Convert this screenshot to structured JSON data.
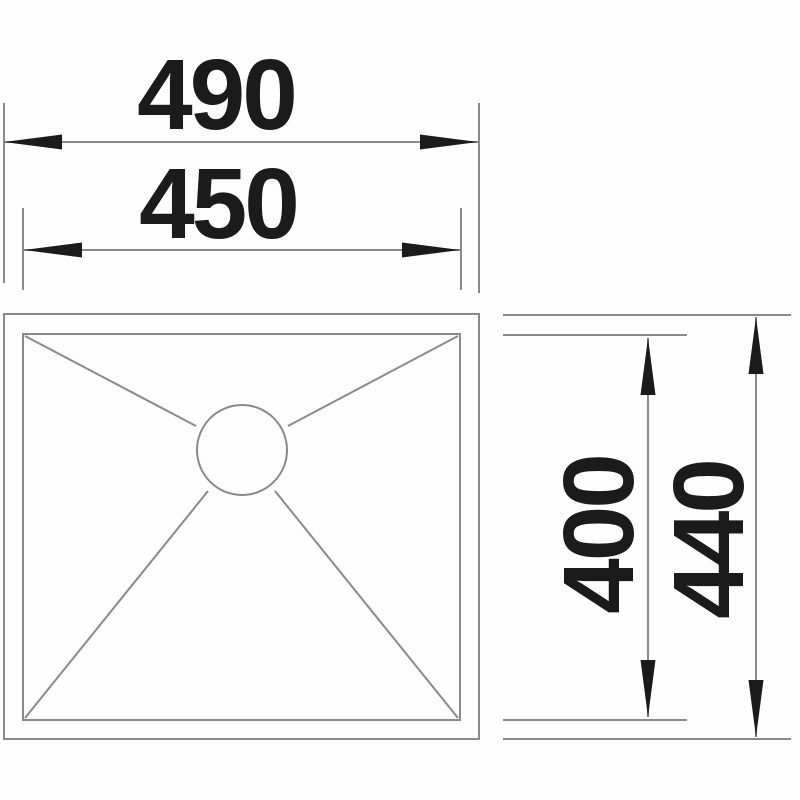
{
  "diagram": {
    "kind": "technical-dimension-drawing",
    "colors": {
      "line": "#8a8a8a",
      "ink": "#1b1b1b",
      "background": "#fdfdfd"
    },
    "dimensions": {
      "outer_width": {
        "label": "490",
        "orientation": "horizontal"
      },
      "inner_width": {
        "label": "450",
        "orientation": "horizontal"
      },
      "inner_depth": {
        "label": "400",
        "orientation": "vertical"
      },
      "outer_depth": {
        "label": "440",
        "orientation": "vertical"
      }
    }
  }
}
